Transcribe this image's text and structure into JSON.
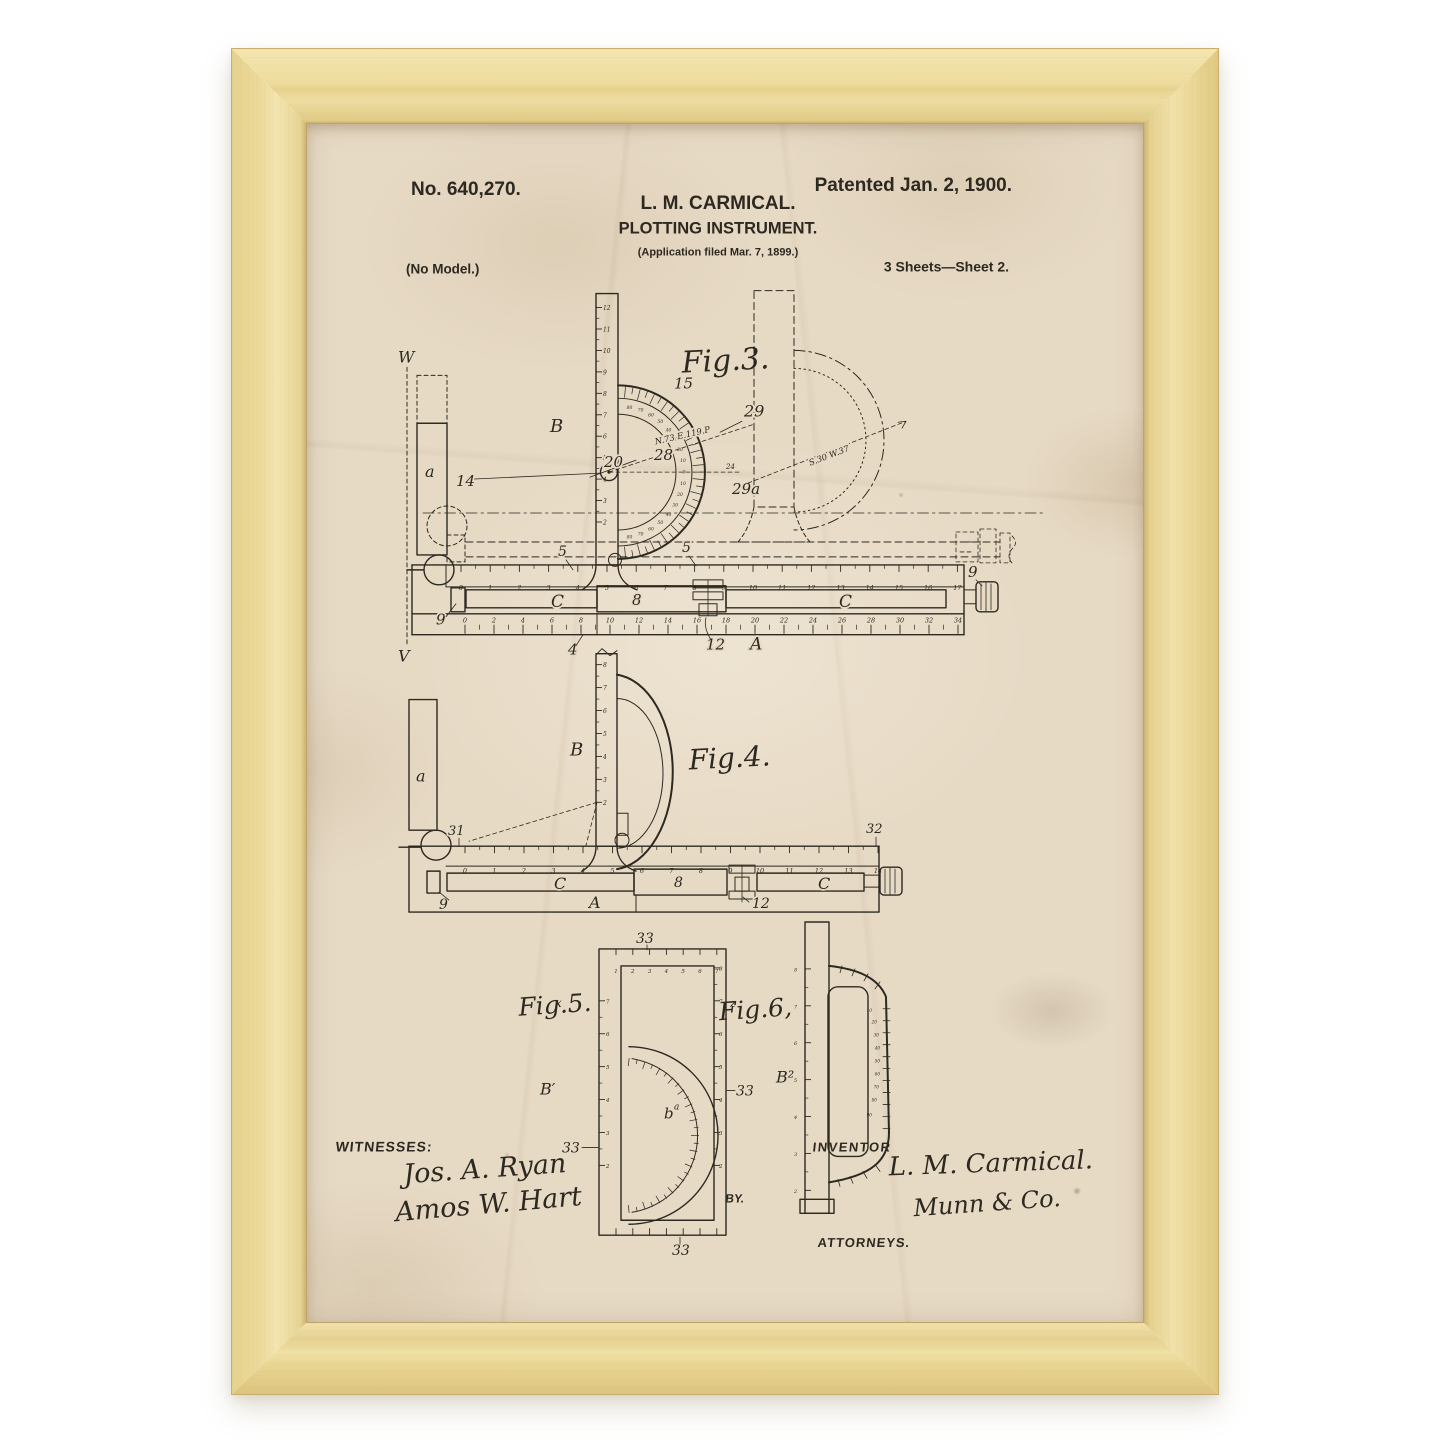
{
  "colors": {
    "page_background": "#ffffff",
    "frame_wood": "#eedc9e",
    "paper": "#e7dac5",
    "ink": "#2d2921"
  },
  "header": {
    "patent_number": "No. 640,270.",
    "patented": "Patented Jan. 2, 1900.",
    "inventor_name": "L. M. CARMICAL.",
    "title": "PLOTTING INSTRUMENT.",
    "application": "(Application filed Mar. 7, 1899.)",
    "no_model": "(No Model.)",
    "sheets": "3 Sheets—Sheet 2."
  },
  "figures": {
    "fig3": {
      "caption": "Fig.3.",
      "ruler_b_scale": [
        12,
        11,
        10,
        9,
        8,
        7,
        6,
        5,
        4,
        3,
        2
      ],
      "top_scale": [
        0,
        1,
        2,
        3,
        4,
        5,
        6,
        7,
        8,
        9,
        10,
        11,
        12,
        13,
        14,
        15,
        16,
        17
      ],
      "bottom_scale": [
        0,
        2,
        4,
        6,
        8,
        10,
        12,
        14,
        16,
        18,
        20,
        22,
        24,
        26,
        28,
        30,
        32,
        34
      ],
      "protractor_degrees": [
        "80",
        "70",
        "60",
        "50",
        "40",
        "30",
        "20",
        "10",
        "0",
        "10",
        "20",
        "30",
        "40",
        "50",
        "60",
        "70",
        "80"
      ],
      "labels": {
        "w": "W",
        "v": "V",
        "arm": "a",
        "ruler": "B",
        "pivot": "14",
        "angle": "20",
        "arc": "15",
        "bearing_mid": "28",
        "bearing_end": "29",
        "bearing_low": "29a",
        "angle_small": "24",
        "offset_left": "5",
        "offset_right": "5",
        "clamp_left": "9",
        "clamp_right": "9",
        "slide_left": "C",
        "slide_center": "8",
        "slide_right": "C",
        "base_tick": "4",
        "screw": "12",
        "base": "A"
      },
      "annotations": {
        "bearing1": "N.73 E.119.P",
        "bearing2": "S.30 W.37"
      }
    },
    "fig4": {
      "caption": "Fig.4.",
      "ruler_b_scale": [
        8,
        7,
        6,
        5,
        4,
        3,
        2
      ],
      "top_scale": [
        0,
        1,
        2,
        3,
        4,
        5,
        6,
        7,
        8,
        9,
        10,
        11,
        12,
        13,
        14
      ],
      "labels": {
        "arm": "a",
        "ruler": "B",
        "left_end": "31",
        "right_end": "32",
        "clamp_left": "9",
        "screw": "12",
        "slide_left": "C",
        "slide_center": "8",
        "slide_right": "C",
        "base": "A"
      }
    },
    "fig5": {
      "caption": "Fig.5.",
      "corner_mark": "x",
      "top_scale": [
        1,
        2,
        3,
        4,
        5,
        6,
        7
      ],
      "left_scale": [
        7,
        6,
        5,
        4,
        3,
        2
      ],
      "right_scale": [
        8,
        7,
        6,
        5,
        4,
        3,
        2
      ],
      "bottom_ticks": [
        "",
        "",
        "",
        "",
        "",
        "",
        ""
      ],
      "labels": {
        "edge_top": "33",
        "edge_right": "33",
        "edge_bottom": "33",
        "edge_left": "33",
        "ruler": "B′",
        "arc": "b",
        "arc_sup": "a"
      }
    },
    "fig6": {
      "caption": "Fig.6,",
      "corner_mark": "z",
      "bar_scale": [
        8,
        7,
        6,
        5,
        4,
        3,
        2
      ],
      "handle_scale": [
        "10",
        "20",
        "30",
        "40",
        "50",
        "60",
        "70",
        "80",
        "90"
      ],
      "labels": {
        "ruler": "B²"
      }
    }
  },
  "witnesses": {
    "heading": "WITNESSES:",
    "signature1": "Jos. A. Ryan",
    "signature2": "Amos W. Hart"
  },
  "inventor": {
    "heading": "INVENTOR",
    "name": "L. M. Carmical.",
    "by": "BY.",
    "signature": "Munn & Co.",
    "attorneys": "ATTORNEYS."
  }
}
